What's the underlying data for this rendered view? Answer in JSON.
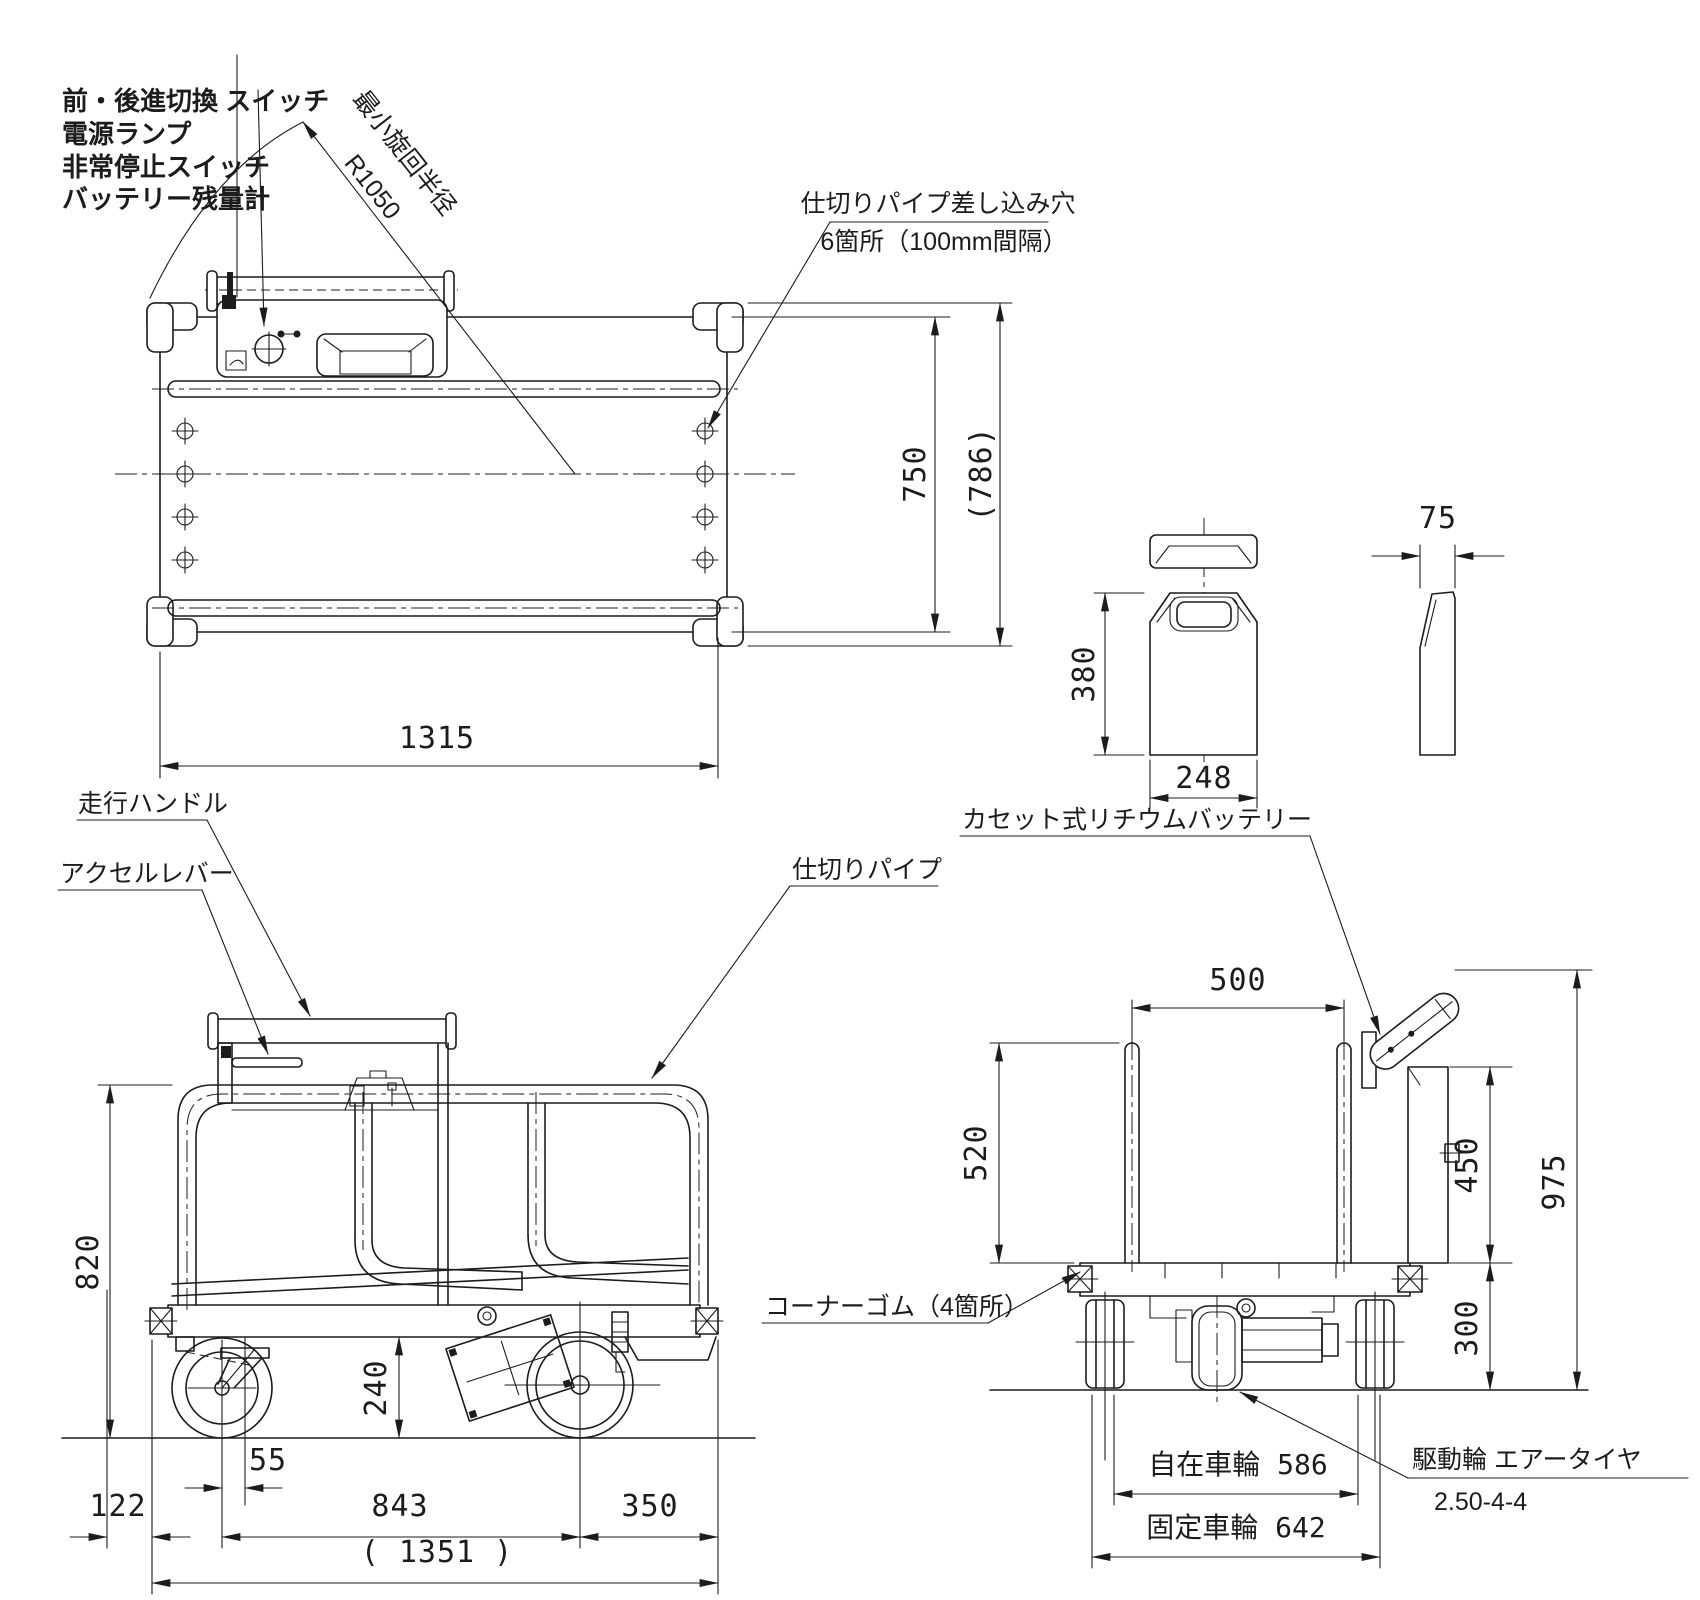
{
  "drawing": {
    "callouts": {
      "switch": "前・後進切換 スイッチ",
      "power_lamp": "電源ランプ",
      "emergency_stop": "非常停止スイッチ",
      "battery_gauge": "バッテリー残量計",
      "min_turn_radius_label": "最小旋回半径",
      "min_turn_radius_value": "R1050",
      "partition_holes_line1": "仕切りパイプ差し込み穴",
      "partition_holes_line2": "6箇所（100mm間隔）",
      "travel_handle": "走行ハンドル",
      "accel_lever": "アクセルレバー",
      "partition_pipe": "仕切りパイプ",
      "cassette_battery": "カセット式リチウムバッテリー",
      "corner_rubber": "コーナーゴム（4箇所）",
      "swivel_wheel_track": "自在車輪 586",
      "fixed_wheel_track": "固定車輪 642",
      "drive_wheel_line1": "駆動輪 エアータイヤ",
      "drive_wheel_line2": "2.50-4-4"
    },
    "dims": {
      "top_view": {
        "inner_width": "750",
        "overall_width": "(786)",
        "length": "1315"
      },
      "battery": {
        "height": "380",
        "width": "248",
        "thickness": "75"
      },
      "side_view": {
        "frame_height": "820",
        "ground_clearance": "240",
        "front_offset": "122",
        "caster_trail": "55",
        "wheelbase": "843",
        "rear_overhang": "350",
        "overall_length": "( 1351 )"
      },
      "rear_view": {
        "pipe_span": "500",
        "pipe_height": "520",
        "box_height": "450",
        "overall_height": "975",
        "deck_height": "300"
      }
    }
  }
}
